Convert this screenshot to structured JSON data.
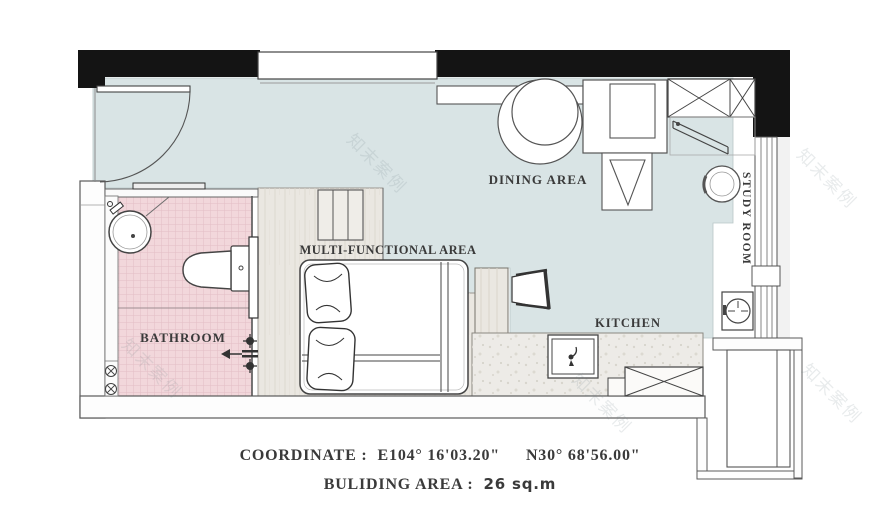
{
  "plan": {
    "type": "floor-plan",
    "rooms": {
      "dining_area": "DINING AREA",
      "multi_functional_area": "MULTI-FUNCTIONAL AREA",
      "kitchen": "KITCHEN",
      "bathroom": "BATHROOM",
      "study_room": "STUDY ROOM"
    },
    "footer": {
      "coordinate_label": "COORDINATE :",
      "coordinate_east": "E104° 16'03.20\"",
      "coordinate_north": "N30° 68'56.00\"",
      "building_label": "BULIDING  AREA :",
      "building_value": "26 sq.m"
    },
    "watermark": "知末案例",
    "colors": {
      "wall_black": "#141414",
      "floor_teal": "#d9e4e5",
      "tile_pink": "#f2d7db",
      "tile_pink_line": "#e3bdc5",
      "wood": "#eae7e1",
      "counter_terrazzo": "#edebe7",
      "line_dark": "#444444",
      "text": "#3a3a3a"
    },
    "icons": [
      "entry-door-icon",
      "window-icon",
      "dining-table-icon",
      "dining-chair-icon",
      "wardrobe-icon",
      "clothes-rail-icon",
      "study-chair-icon",
      "study-appliance-icon",
      "bed-icon",
      "pillow-icon",
      "storage-steps-icon",
      "lounge-chair-icon",
      "kitchen-sink-icon",
      "stove-icon",
      "bathroom-sink-icon",
      "toilet-icon",
      "shower-valve-icon",
      "floor-drain-icon",
      "ac-platform-icon"
    ]
  }
}
